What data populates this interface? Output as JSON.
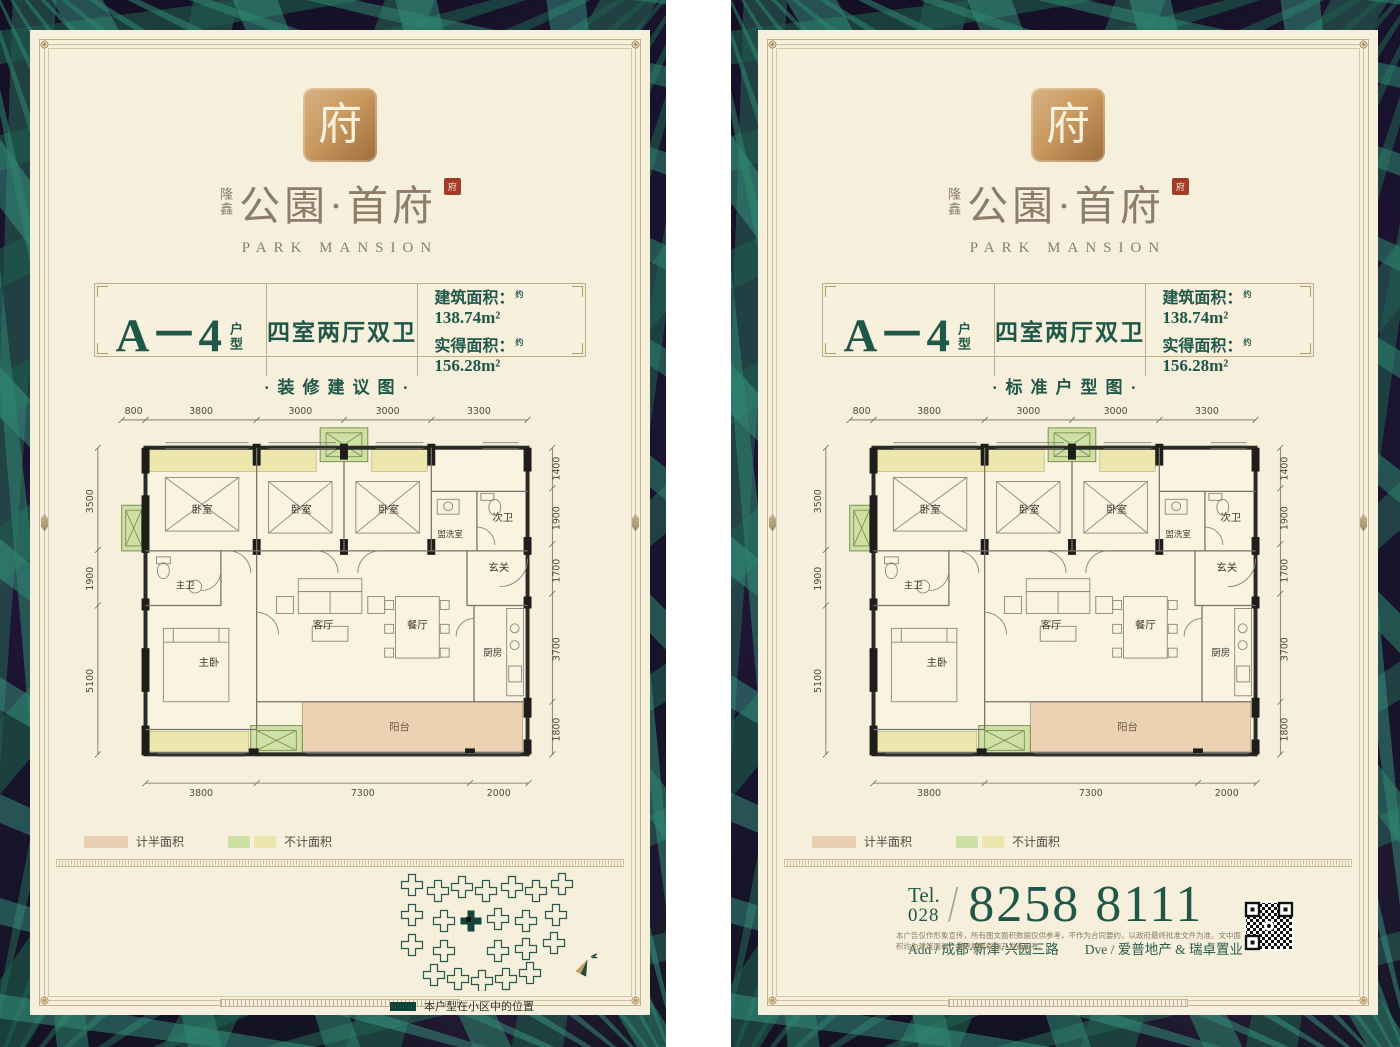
{
  "colors": {
    "poster_bg": "#f6efdc",
    "frame_gold": "#c4b28f",
    "dark_green": "#1f5748",
    "brand_brown": "#8d7d68",
    "seal_gold": "#c99a61",
    "seal_red": "#a23b28",
    "wall_black": "#1e1d1a",
    "half_area_swatch": "#e9cfb1",
    "excluded_green_swatch": "#cfe0a5",
    "excluded_yellow_swatch": "#ece6ad",
    "site_marker": "#12463a"
  },
  "logo": {
    "seal_glyph": "府",
    "brand_cn_small": "隆鑫",
    "brand_cn": "公園·首府",
    "brand_en": "PARK MANSION"
  },
  "header": {
    "unit_code": "A－4",
    "unit_code_suffix": "户型",
    "layout": "四室两厅双卫",
    "areas": [
      {
        "label": "建筑面积：",
        "approx": "约",
        "value": "138.74m²"
      },
      {
        "label": "实得面积：",
        "approx": "约",
        "value": "156.28m²"
      }
    ]
  },
  "posters": [
    {
      "subtitle": "·装修建议图·"
    },
    {
      "subtitle": "·标准户型图·"
    }
  ],
  "plan": {
    "dims_top": [
      "800",
      "3800",
      "3000",
      "3000",
      "3300"
    ],
    "dims_left": [
      "3500",
      "1900",
      "5100"
    ],
    "dims_right": [
      "1400",
      "1900",
      "1700",
      "3700",
      "1800"
    ],
    "dims_bottom": [
      "3800",
      "7300",
      "2000"
    ],
    "rooms": {
      "bedroom1": "卧室",
      "bedroom2": "卧室",
      "bedroom3": "卧室",
      "washroom": "盥洗室",
      "bath2": "次卫",
      "bath1": "主卫",
      "foyer": "玄关",
      "master": "主卧",
      "living": "客厅",
      "dining": "餐厅",
      "kitchen": "厨房",
      "balcony": "阳台"
    }
  },
  "legend": {
    "half_label": "计半面积",
    "excluded_label": "不计面积"
  },
  "site_plan": {
    "caption": "本户型在小区中的位置"
  },
  "contact": {
    "tel_label": "Tel.",
    "tel_area": "028",
    "slash": "/",
    "tel_number": "8258 8111",
    "address": "Add / 成都·新津·兴园三路",
    "agency": "Dve / 爱普地产 & 瑞卓置业",
    "disclaimer": "本广告仅作形象宣传，所有图文面积数据仅供参考，不作为合同要约，以政府最终批准文件为准。文中面积均为建筑面积，最终解释权归开发商所有。"
  }
}
